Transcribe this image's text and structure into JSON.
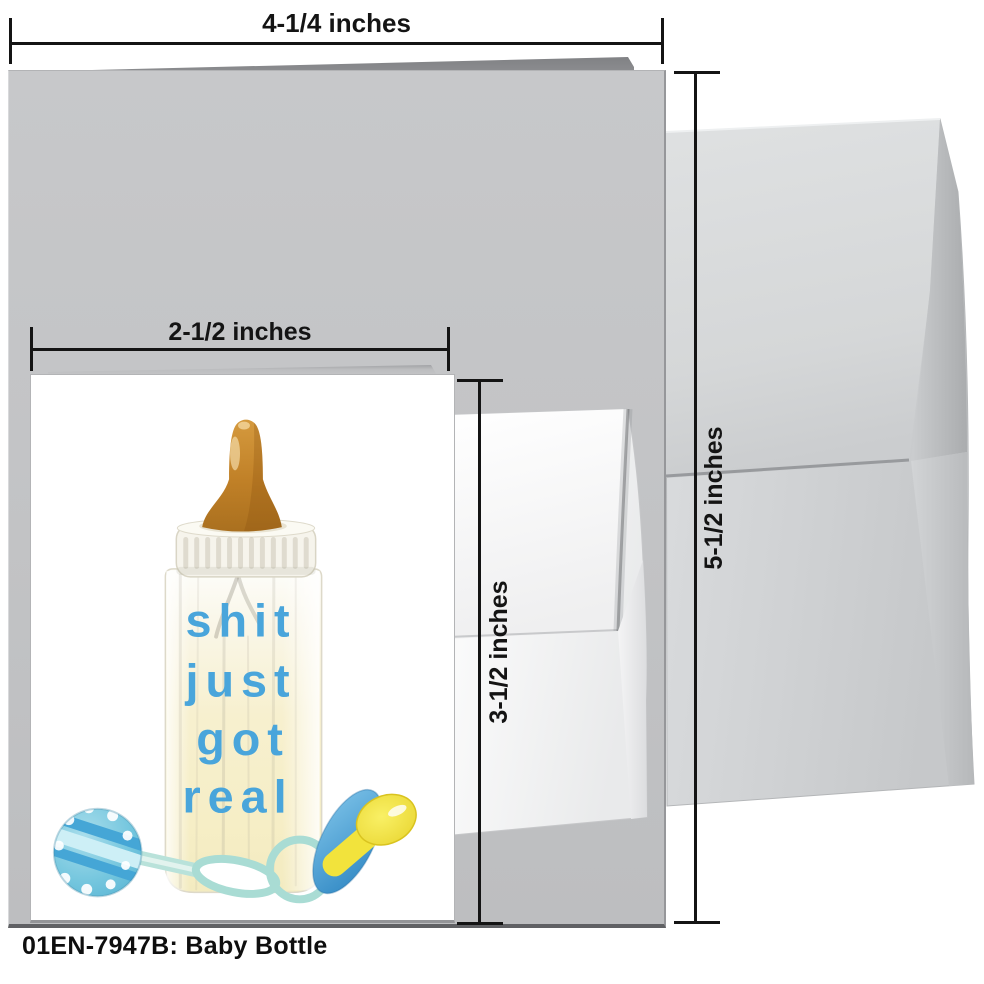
{
  "caption": "01EN-7947B: Baby Bottle",
  "dimensions": {
    "large_card_width": "4-1/4 inches",
    "large_card_height": "5-1/2 inches",
    "small_card_width": "2-1/2 inches",
    "small_card_height": "3-1/2 inches"
  },
  "artwork": {
    "lines": [
      "shit",
      "just",
      "got",
      "real"
    ],
    "text_color": "#49a5db"
  },
  "colors": {
    "large_card_gray": "#c3c4c6",
    "envelope_gray": "#d4d6d7",
    "small_card_white": "#ffffff",
    "nipple_amber": "#c08027",
    "rattle_blue": "#74c6de",
    "pacifier_shield_blue": "#4ea9dc",
    "pacifier_handle_yellow": "#f2e33c",
    "dimension_line_black": "#141414"
  }
}
